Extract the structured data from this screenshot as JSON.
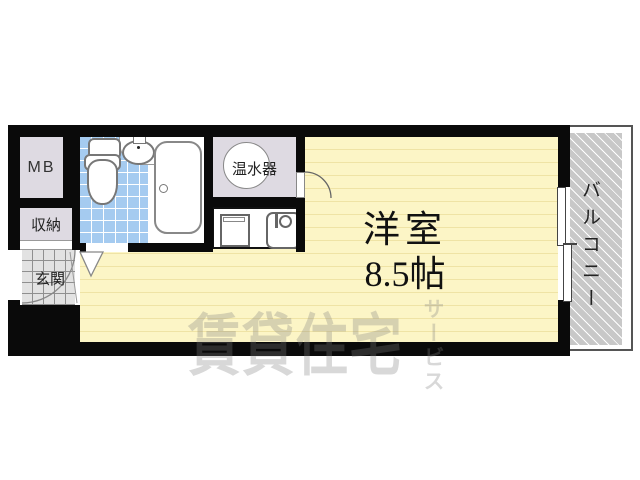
{
  "rooms": {
    "main_room": {
      "name": "洋室",
      "size": "8.5帖"
    },
    "balcony": {
      "label": "バルコニー"
    },
    "entrance": {
      "label": "玄関"
    },
    "storage": {
      "label": "収納"
    },
    "meter_box": {
      "label": "MB"
    },
    "water_heater": {
      "label": "温水器"
    }
  },
  "watermark": {
    "brand_main": "賃貸住宅",
    "brand_sub": "サービス"
  },
  "fixtures": {
    "toilet": "toilet-icon",
    "washbasin": "washbasin-icon",
    "bathtub": "bathtub-icon",
    "water_heater_tank": "water-heater-circle-icon",
    "kitchen_cabinet": "kitchen-cabinet-icon",
    "kitchen_sink": "kitchen-sink-icon",
    "sliding_window": "sliding-window-icon",
    "room_door": "door-swing-arc-icon",
    "entrance_door": "door-swing-arc-icon",
    "bathroom_door": "folding-door-mark-icon"
  },
  "colors": {
    "wall": "#0a0a0a",
    "floor": "#fcf5c6",
    "floor-line": "#efe3a5",
    "tile": "#a5cbf0",
    "unit": "#dedae2",
    "genkan": "#e2e2e2",
    "balcony": "#c8c8c8"
  }
}
